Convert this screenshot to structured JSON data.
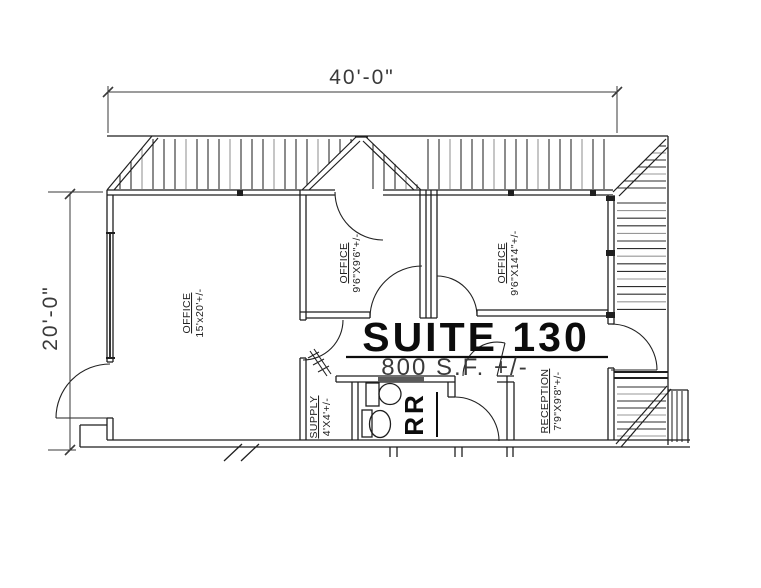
{
  "dimensions": {
    "width": "40'-0\"",
    "height": "20'-0\""
  },
  "suite": {
    "name": "SUITE 130",
    "area": "800 S.F. +/-"
  },
  "rooms": {
    "office_large": {
      "label": "OFFICE",
      "size": "15'x20'+/-"
    },
    "office_middle": {
      "label": "OFFICE",
      "size": "9'6\"X9'6\"+/-"
    },
    "office_right": {
      "label": "OFFICE",
      "size": "9'6\"X14'4\"+/-"
    },
    "supply": {
      "label": "SUPPLY",
      "size": "4'X4'+/-"
    },
    "restroom": {
      "label": "RR"
    },
    "reception": {
      "label": "RECEPTION",
      "size": "7'9\"X9'8\"+/-"
    }
  },
  "colors": {
    "line": "#1f1f1f",
    "hatch_dark": "#2e2e2e",
    "hatch_light": "#979797",
    "text": "#3a3a3a",
    "bold_text": "#0c0c0c",
    "background": "#ffffff"
  }
}
